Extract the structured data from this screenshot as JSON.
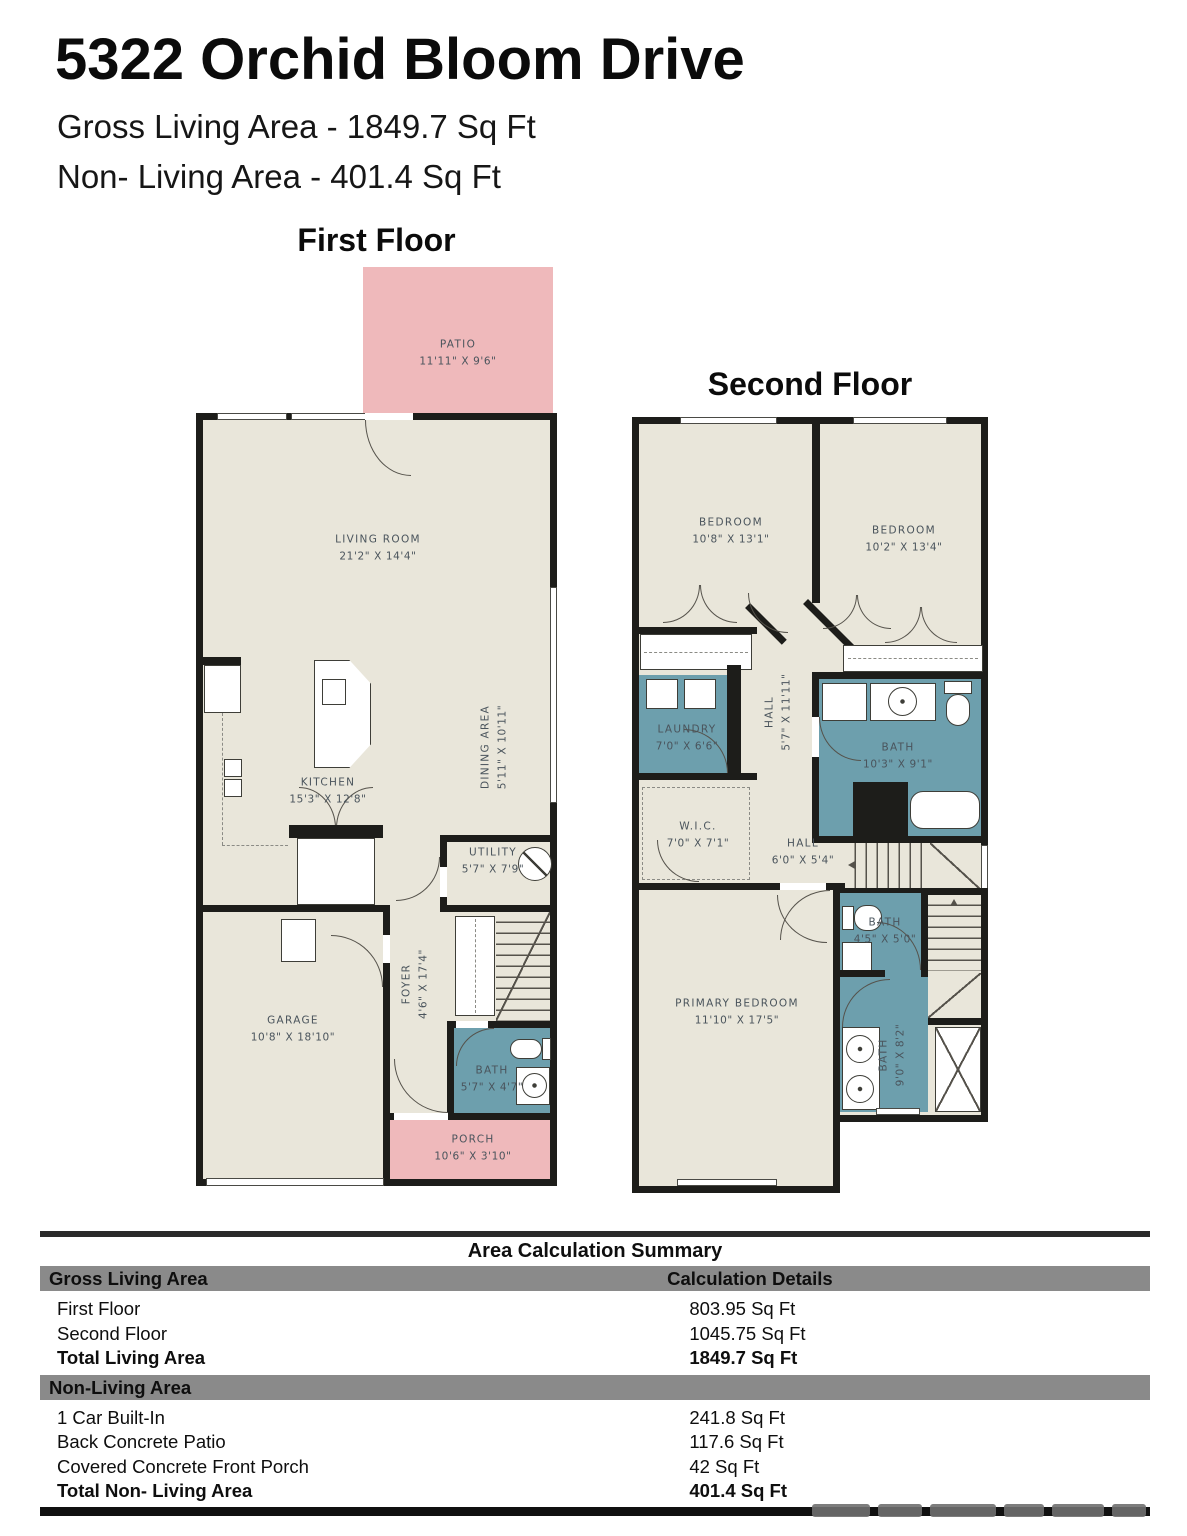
{
  "header": {
    "title": "5322 Orchid Bloom Drive",
    "subtitle1": "Gross Living Area - 1849.7 Sq Ft",
    "subtitle2": "Non- Living Area - 401.4 Sq Ft"
  },
  "first_floor": {
    "heading": "First Floor",
    "rooms": {
      "patio": {
        "label": "PATIO",
        "dims": "11'11\" X 9'6\""
      },
      "living_room": {
        "label": "LIVING ROOM",
        "dims": "21'2\" X 14'4\""
      },
      "kitchen": {
        "label": "KITCHEN",
        "dims": "15'3\" X 12'8\""
      },
      "dining_area": {
        "label": "DINING AREA",
        "dims": "5'11\" X 10'11\""
      },
      "utility": {
        "label": "UTILITY",
        "dims": "5'7\" X 7'9\""
      },
      "garage": {
        "label": "GARAGE",
        "dims": "10'8\" X 18'10\""
      },
      "foyer": {
        "label": "FOYER",
        "dims": "4'6\" X 17'4\""
      },
      "bath": {
        "label": "BATH",
        "dims": "5'7\" X 4'7\""
      },
      "porch": {
        "label": "PORCH",
        "dims": "10'6\" X 3'10\""
      }
    }
  },
  "second_floor": {
    "heading": "Second Floor",
    "rooms": {
      "bedroom_left": {
        "label": "BEDROOM",
        "dims": "10'8\" X 13'1\""
      },
      "bedroom_right": {
        "label": "BEDROOM",
        "dims": "10'2\" X 13'4\""
      },
      "laundry": {
        "label": "LAUNDRY",
        "dims": "7'0\" X 6'6\""
      },
      "hall_upper": {
        "label": "HALL",
        "dims": "5'7\" X 11'11\""
      },
      "bath_main": {
        "label": "BATH",
        "dims": "10'3\" X 9'1\""
      },
      "wic": {
        "label": "W.I.C.",
        "dims": "7'0\" X 7'1\""
      },
      "hall_lower": {
        "label": "HALL",
        "dims": "6'0\" X 5'4\""
      },
      "primary_bedroom": {
        "label": "PRIMARY BEDROOM",
        "dims": "11'10\" X 17'5\""
      },
      "bath_small": {
        "label": "BATH",
        "dims": "4'5\" X 5'0\""
      },
      "bath_primary": {
        "label": "BATH",
        "dims": "9'0\" X 8'2\""
      }
    }
  },
  "summary_table": {
    "title": "Area Calculation Summary",
    "living_header": "Gross Living Area",
    "details_header": "Calculation Details",
    "living_rows": [
      {
        "label": "First Floor",
        "value": "803.95 Sq Ft"
      },
      {
        "label": "Second Floor",
        "value": "1045.75 Sq Ft"
      },
      {
        "label": "Total Living Area",
        "value": "1849.7 Sq Ft"
      }
    ],
    "non_living_header": "Non-Living Area",
    "non_living_rows": [
      {
        "label": "1 Car Built-In",
        "value": "241.8 Sq Ft"
      },
      {
        "label": "Back Concrete Patio",
        "value": "117.6 Sq Ft"
      },
      {
        "label": "Covered Concrete Front Porch",
        "value": "42 Sq Ft"
      },
      {
        "label": "Total Non- Living Area",
        "value": "401.4 Sq Ft"
      }
    ]
  },
  "colors": {
    "room_fill": "#e9e6da",
    "wet_room_fill": "#6d9fad",
    "outdoor_fill": "#efb9bb",
    "wall": "#1d1d1a",
    "label_text": "#4a545c",
    "table_bar": "#8a8a8a"
  }
}
